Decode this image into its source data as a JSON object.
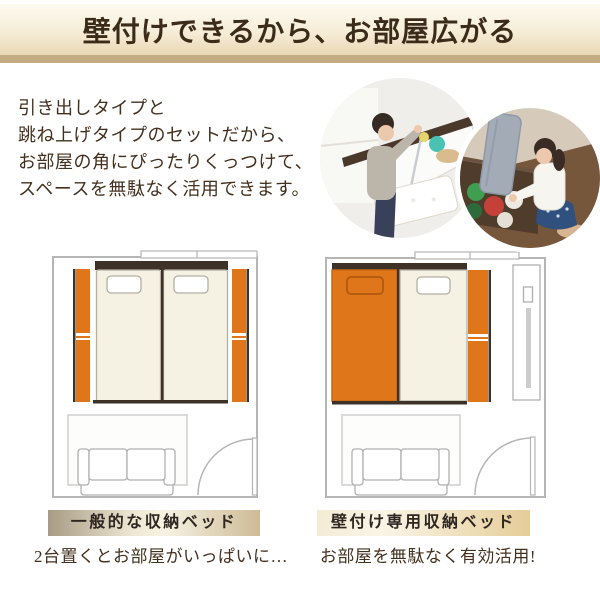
{
  "banner": {
    "title": "壁付けできるから、お部屋広がる"
  },
  "intro": {
    "lines": [
      "引き出しタイプと",
      "跳ね上げタイプのセットだから、",
      "お部屋の角にぴったりくっつけて、",
      "スペースを無駄なく活用できます。"
    ]
  },
  "comparison": {
    "left": {
      "label": "一般的な収納ベッド",
      "caption": "2台置くとお部屋がいっぱいに…"
    },
    "right": {
      "label": "壁付け専用収納ベッド",
      "caption": "お部屋を無駄なく有効活用!"
    }
  },
  "colors": {
    "orange": "#e0761a",
    "orangedark": "#b55c10",
    "frame": "#3e3128",
    "cream": "#f5f2e4",
    "creamline": "#b3aea3",
    "wall": "#b5b5b5",
    "strip": "#c3ab82",
    "textdark": "#3b2b19",
    "textbody": "#43301e",
    "labeltext": "#2e2620"
  }
}
